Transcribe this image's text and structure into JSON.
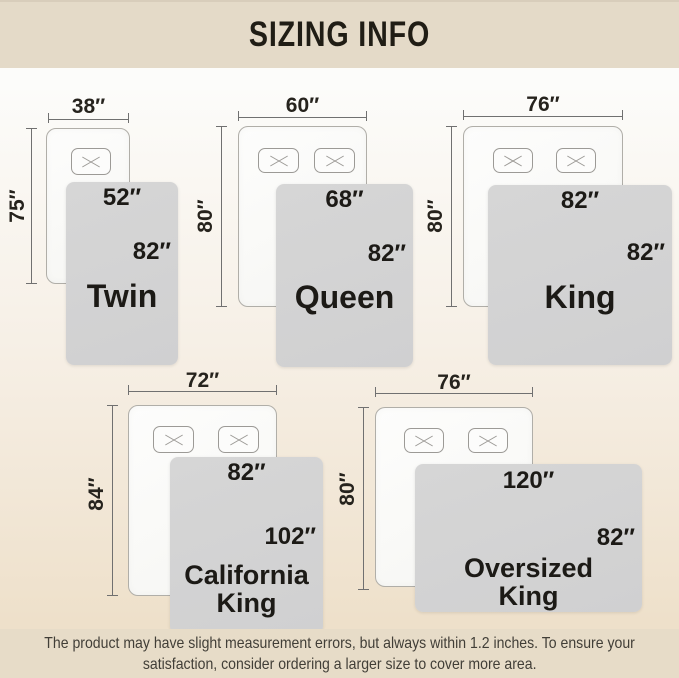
{
  "header": {
    "title": "SIZING INFO"
  },
  "footer": {
    "line1": "The product may have slight measurement errors, but always within 1.2 inches. To ensure your",
    "line2": "satisfaction, consider ordering a larger size to cover more area."
  },
  "beds": [
    {
      "name": "Twin",
      "mattress_width": "38″",
      "mattress_height": "75″",
      "blanket_width": "52″",
      "blanket_height": "82″"
    },
    {
      "name": "Queen",
      "mattress_width": "60″",
      "mattress_height": "80″",
      "blanket_width": "68″",
      "blanket_height": "82″"
    },
    {
      "name": "King",
      "mattress_width": "76″",
      "mattress_height": "80″",
      "blanket_width": "82″",
      "blanket_height": "82″"
    },
    {
      "name": "California King",
      "mattress_width": "72″",
      "mattress_height": "84″",
      "blanket_width": "82″",
      "blanket_height": "102″"
    },
    {
      "name": "Oversized King",
      "mattress_width": "76″",
      "mattress_height": "80″",
      "blanket_width": "120″",
      "blanket_height": "82″"
    }
  ],
  "colors": {
    "bar_bg": "#e4dac8",
    "content_top": "#fcfcfa",
    "content_bottom": "#eee0ca",
    "mattress": "#fbfbf9",
    "blanket": "#d3d3d3",
    "dim_line": "#707070",
    "text_dark": "#1c1a16"
  }
}
